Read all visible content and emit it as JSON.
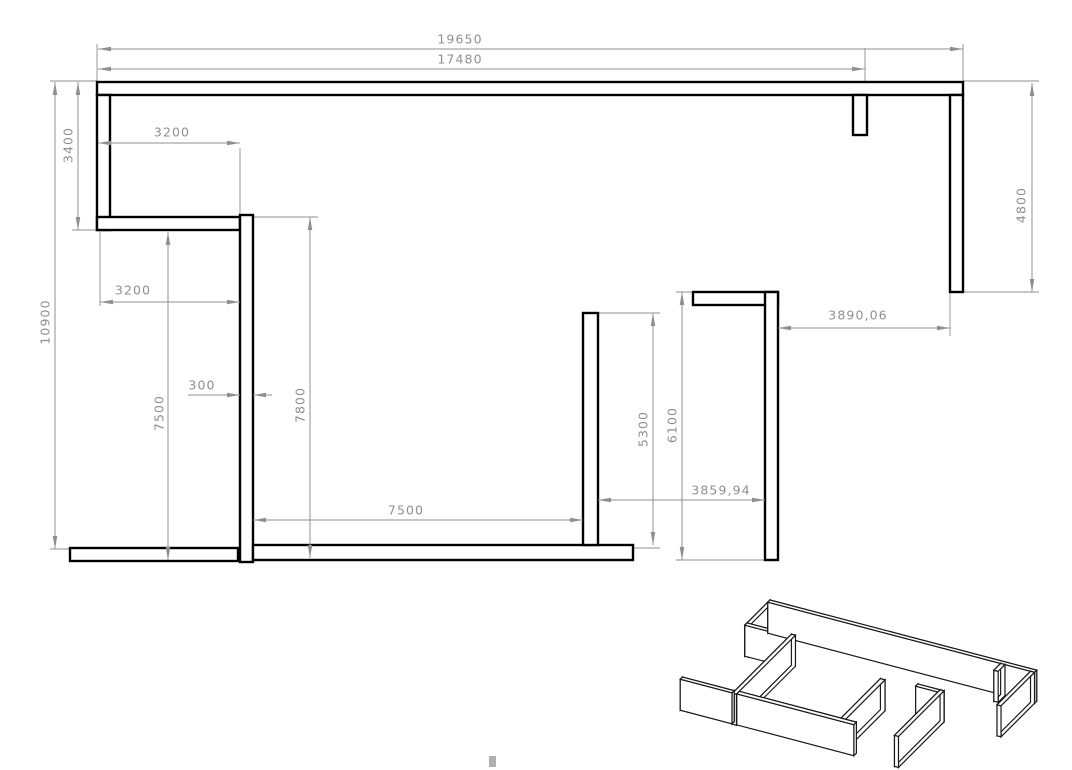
{
  "drawing": {
    "background": "#ffffff",
    "wall_outline_color": "#000000",
    "wall_fill_color": "#ffffff",
    "dim_color": "#8f8f8f",
    "iso_outline_color": "#1a1a1a",
    "canvas": {
      "width": 1072,
      "height": 770
    },
    "walls": [
      {
        "id": "top-wall",
        "x": 97,
        "y": 82,
        "w": 866,
        "h": 13
      },
      {
        "id": "left-wall",
        "x": 97,
        "y": 95,
        "w": 13,
        "h": 135
      },
      {
        "id": "upper-left-partition",
        "x": 97,
        "y": 217,
        "w": 143,
        "h": 13
      },
      {
        "id": "interior-long-partition",
        "x": 240,
        "y": 215,
        "w": 13,
        "h": 347
      },
      {
        "id": "bottom-left-wall",
        "x": 70,
        "y": 548,
        "w": 168,
        "h": 13
      },
      {
        "id": "bottom-middle-wall",
        "x": 253,
        "y": 545,
        "w": 380,
        "h": 15
      },
      {
        "id": "middle-partition",
        "x": 583,
        "y": 313,
        "w": 15,
        "h": 232
      },
      {
        "id": "l-wall-horizontal",
        "x": 693,
        "y": 292,
        "w": 85,
        "h": 13
      },
      {
        "id": "l-wall-vertical",
        "x": 765,
        "y": 292,
        "w": 13,
        "h": 268
      },
      {
        "id": "right-wall",
        "x": 950,
        "y": 95,
        "w": 13,
        "h": 197
      },
      {
        "id": "top-wall-stub",
        "x": 853,
        "y": 95,
        "w": 14,
        "h": 40
      }
    ],
    "dims": [
      {
        "dir": "h",
        "label": "19650",
        "a": 98,
        "b": 963,
        "pos": 49,
        "tx": 460,
        "ty": 40
      },
      {
        "dir": "h",
        "label": "17480",
        "a": 98,
        "b": 865,
        "pos": 69,
        "tx": 460,
        "ty": 60
      },
      {
        "dir": "h",
        "label": "3200",
        "a": 98,
        "b": 240,
        "pos": 143,
        "tx": 172,
        "ty": 133
      },
      {
        "dir": "h",
        "label": "3200",
        "a": 100,
        "b": 240,
        "pos": 302,
        "tx": 133,
        "ty": 291
      },
      {
        "dir": "h",
        "label": "300",
        "a": 240,
        "b": 253,
        "pos": 395,
        "tx": 202,
        "ty": 386,
        "outside": true,
        "line_from": 188,
        "line_to": 272
      },
      {
        "dir": "h",
        "label": "7500",
        "a": 253,
        "b": 583,
        "pos": 520,
        "tx": 406,
        "ty": 511
      },
      {
        "dir": "h",
        "label": "3859,94",
        "a": 598,
        "b": 765,
        "pos": 500,
        "tx": 721,
        "ty": 491
      },
      {
        "dir": "h",
        "label": "3890,06",
        "a": 778,
        "b": 950,
        "pos": 328,
        "tx": 858,
        "ty": 316
      },
      {
        "dir": "v",
        "label": "10900",
        "a": 82,
        "b": 549,
        "pos": 55,
        "tx": 46,
        "ty": 322
      },
      {
        "dir": "v",
        "label": "3400",
        "a": 82,
        "b": 230,
        "pos": 78,
        "tx": 69,
        "ty": 145
      },
      {
        "dir": "v",
        "label": "7500",
        "a": 232,
        "b": 560,
        "pos": 168,
        "tx": 160,
        "ty": 413
      },
      {
        "dir": "v",
        "label": "7800",
        "a": 217,
        "b": 558,
        "pos": 310,
        "tx": 301,
        "ty": 405
      },
      {
        "dir": "v",
        "label": "5300",
        "a": 313,
        "b": 545,
        "pos": 653,
        "tx": 644,
        "ty": 429
      },
      {
        "dir": "v",
        "label": "6100",
        "a": 292,
        "b": 560,
        "pos": 682,
        "tx": 673,
        "ty": 425
      },
      {
        "dir": "v",
        "label": "4800",
        "a": 83,
        "b": 292,
        "pos": 1032,
        "tx": 1022,
        "ty": 205
      }
    ],
    "ext_lines": [
      [
        97,
        44,
        97,
        81
      ],
      [
        963,
        44,
        963,
        81
      ],
      [
        865,
        48,
        865,
        82
      ],
      [
        240,
        148,
        240,
        215
      ],
      [
        100,
        232,
        100,
        306
      ],
      [
        50,
        81,
        97,
        81
      ],
      [
        50,
        549,
        70,
        549
      ],
      [
        72,
        230,
        97,
        230
      ],
      [
        253,
        217,
        318,
        217
      ],
      [
        598,
        313,
        660,
        313
      ],
      [
        633,
        548,
        660,
        548
      ],
      [
        676,
        292,
        695,
        292
      ],
      [
        676,
        560,
        765,
        560
      ],
      [
        963,
        81,
        1039,
        81
      ],
      [
        963,
        292,
        1039,
        292
      ],
      [
        950,
        292,
        950,
        336
      ]
    ],
    "iso": {
      "origin_x": 770,
      "origin_y": 631,
      "xx": 0.308,
      "xy": 0.081,
      "yx": -0.17,
      "yy": 0.17,
      "wall_height": 31,
      "plan_origin_x": 97,
      "plan_origin_y": 82
    },
    "artifact": {
      "x": 489,
      "y": 756,
      "w": 7,
      "h": 11,
      "color": "#b0b0b0"
    }
  }
}
